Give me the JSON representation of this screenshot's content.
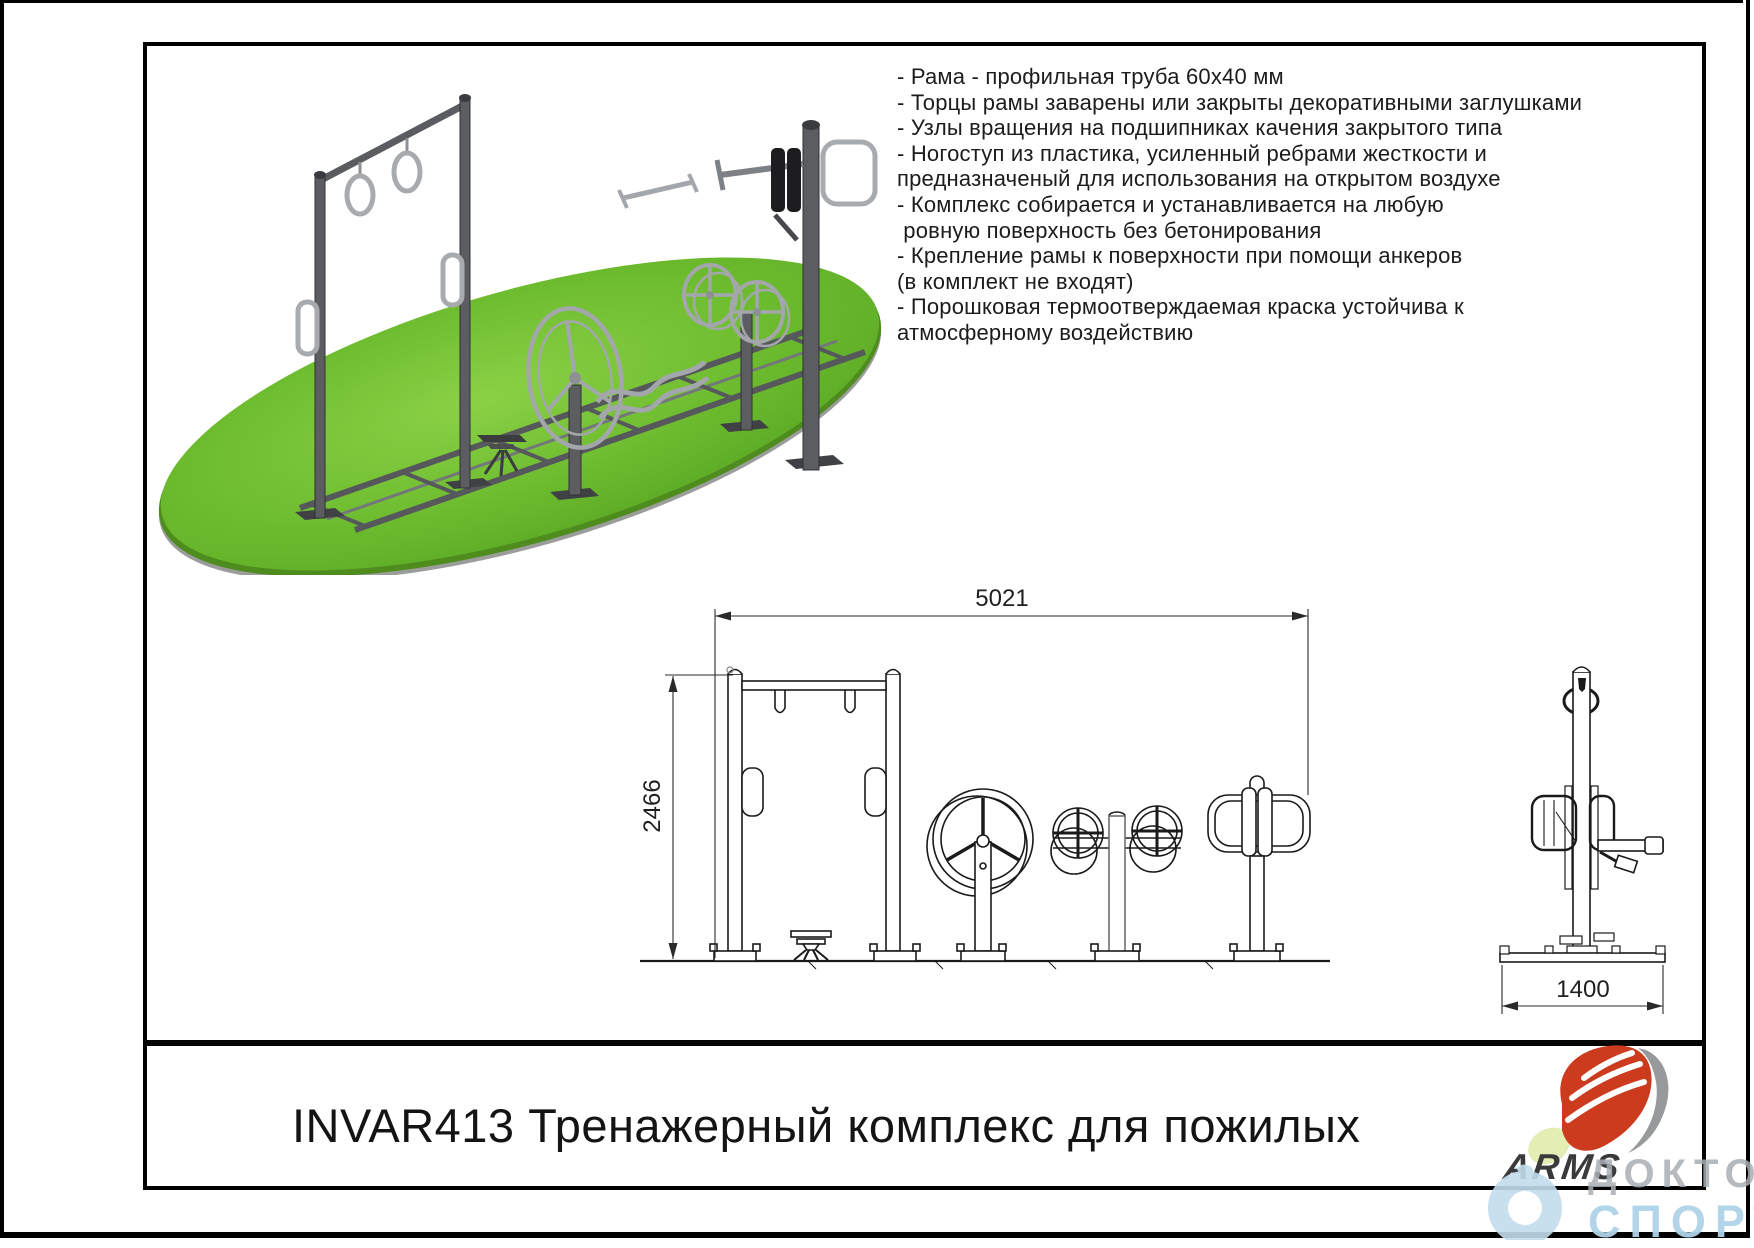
{
  "title_block": {
    "title": "INVAR413 Тренажерный комплекс для пожилых"
  },
  "specs": {
    "lines": [
      "- Рама - профильная труба 60x40 мм",
      "- Торцы рамы заварены или закрыты декоративными заглушками",
      "- Узлы вращения на подшипниках качения закрытого типа",
      "- Ногоступ из пластика, усиленный ребрами жесткости и",
      "предназначеный для использования на открытом воздухе",
      "- Комплекс собирается и устанавливается на любую",
      " ровную поверхность без бетонирования",
      "- Крепление рамы к поверхности при помощи анкеров",
      "(в комплект не входят)",
      "- Порошковая термоотверждаемая краска устойчива к",
      "атмосферному воздействию"
    ]
  },
  "drawings": {
    "front": {
      "width_label": "5021",
      "height_label": "2466"
    },
    "side": {
      "width_label": "1400"
    }
  },
  "brand": {
    "logo_text": "ARMS"
  },
  "watermark": {
    "line1": "ДОКТОР",
    "line2": "СПОРТ"
  },
  "colors": {
    "grass_green": "#67b82e",
    "grass_dark": "#4e8c1d",
    "metal_gray": "#55575a",
    "chrome": "#a8abae",
    "logo_red": "#cc3b1e",
    "logo_gray": "#97999b",
    "watermark_blue": "#aed3e8",
    "watermark_gray": "#a9aeb4",
    "line_black": "#1a1a1a"
  }
}
